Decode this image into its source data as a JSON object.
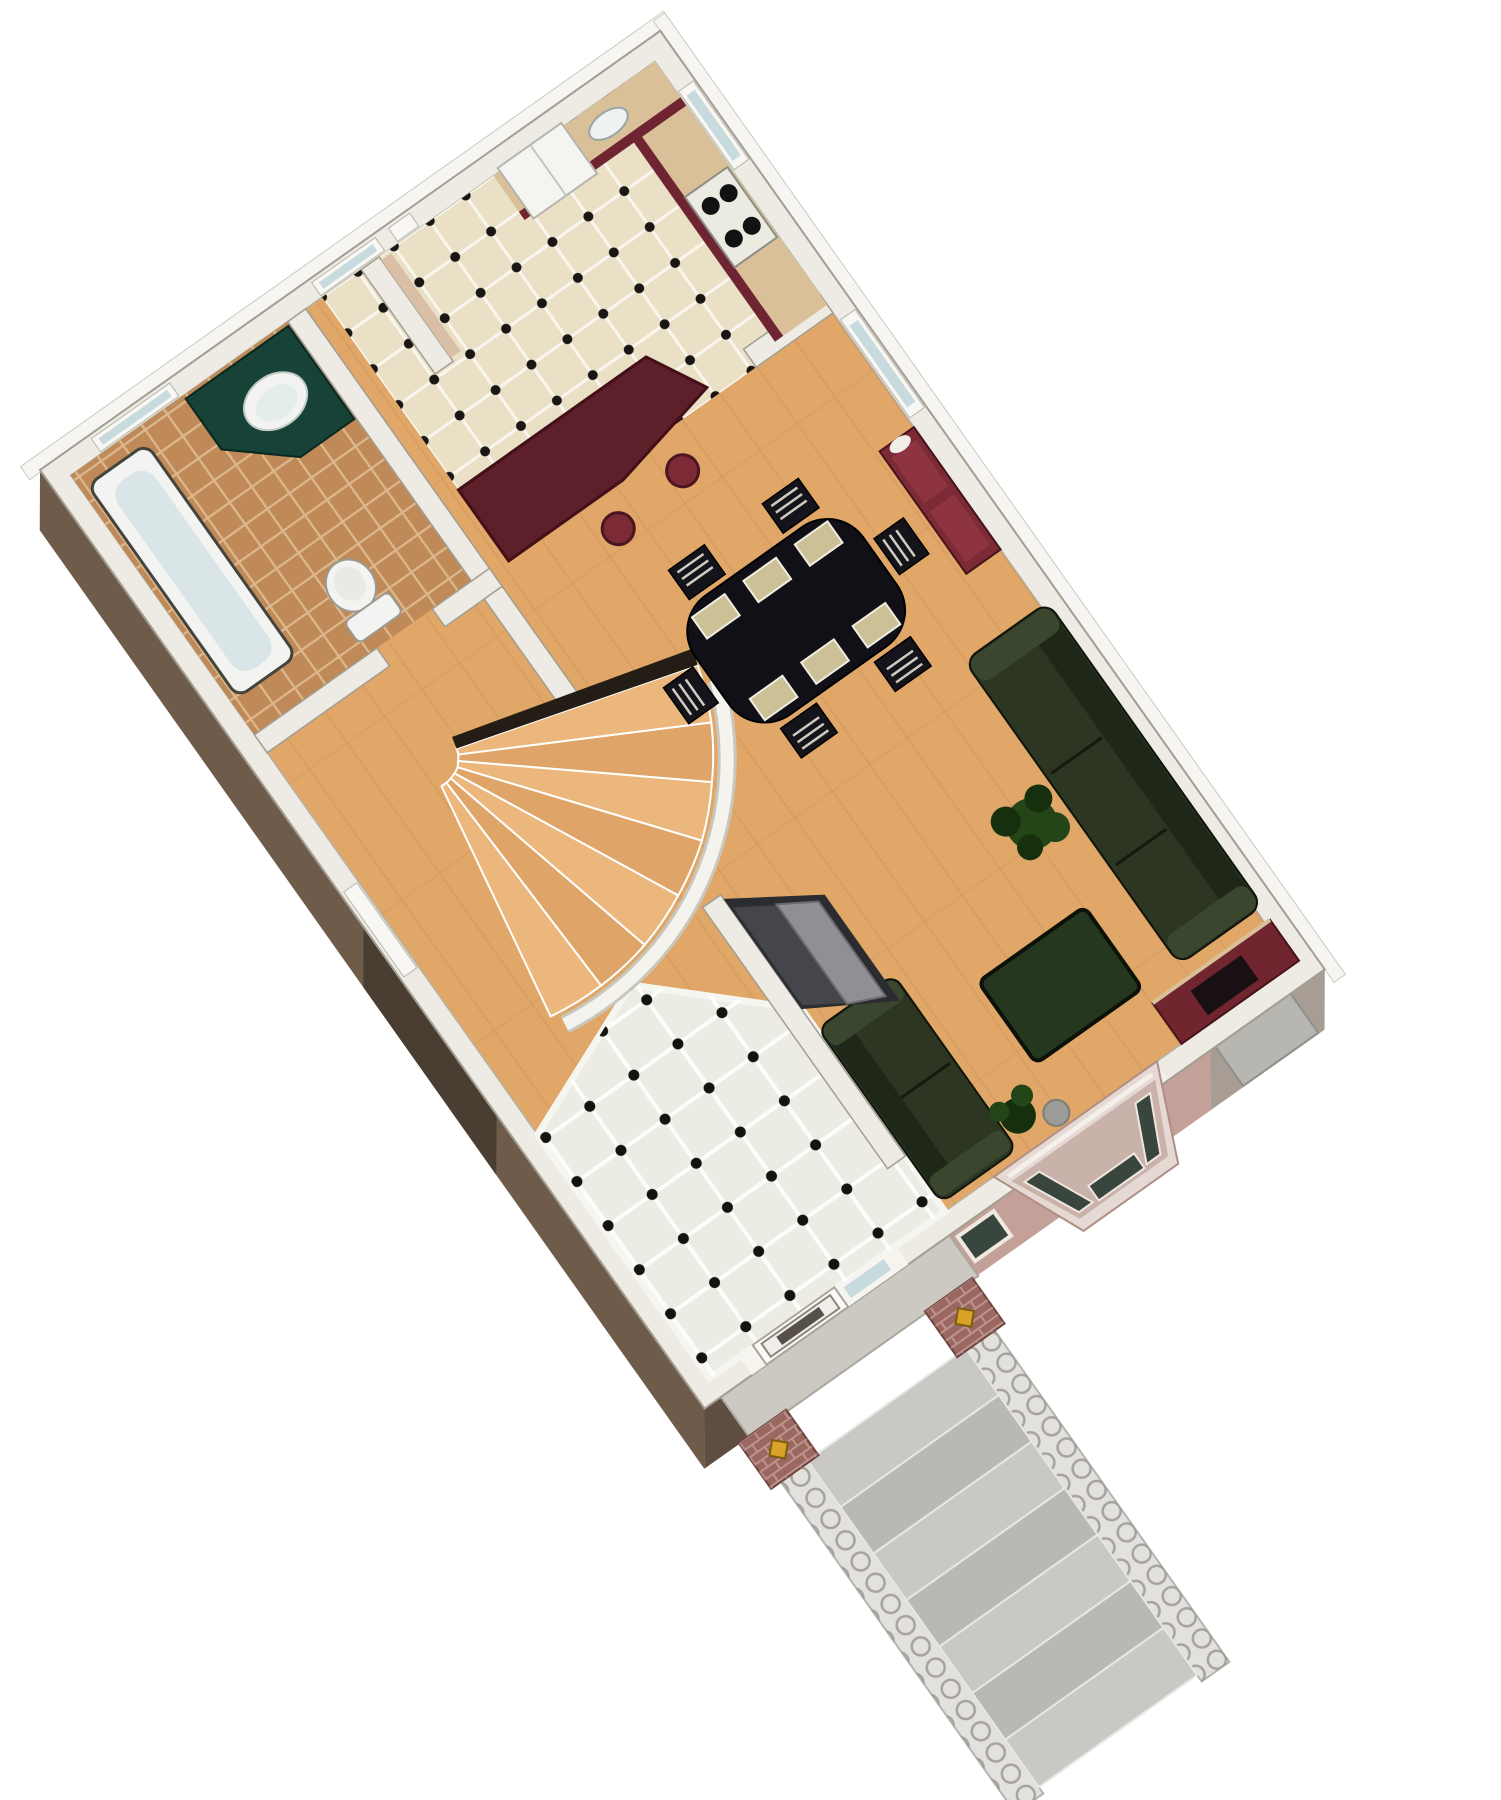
{
  "scene": {
    "type": "3d-floor-plan-render",
    "view": "isometric aerial cutaway, plan rotated about -35 degrees",
    "floor": "first floor",
    "background": "#ffffff"
  },
  "rooms": [
    {
      "name": "kitchen",
      "floor_finish": "cream tile with black diamond dots"
    },
    {
      "name": "dining-area",
      "floor_finish": "hardwood"
    },
    {
      "name": "living-room",
      "floor_finish": "hardwood"
    },
    {
      "name": "bathroom",
      "floor_finish": "terracotta grid tile"
    },
    {
      "name": "hall-stairs",
      "floor_finish": "hardwood winder staircase"
    },
    {
      "name": "foyer",
      "floor_finish": "white tile with black diamond dots"
    },
    {
      "name": "entry-porch",
      "floor_finish": "concrete with brick piers"
    }
  ],
  "furniture": [
    "refrigerator",
    "range-cooktop",
    "kitchen-counter",
    "peninsula-counter",
    "bar-stool",
    "bar-stool",
    "dining-table",
    "dining-chair x6",
    "placemats x6",
    "china-hutch",
    "sofa",
    "loveseat",
    "coffee-table",
    "potted-plant",
    "potted-plant",
    "decor-ball",
    "fireplace",
    "chimney",
    "bay-window",
    "bathtub",
    "vanity-with-sink",
    "toilet",
    "closet-doors",
    "front-door",
    "sidelight",
    "porch-sconce x2",
    "exterior-steps"
  ],
  "palette": {
    "wall_top": "#edebe3",
    "wall_edge": "#a29e92",
    "fascia": "#f6f5f1",
    "wood": "#e0a768",
    "kitchen_tile": "#e9e0c6",
    "foyer_tile": "#ecece4",
    "bath_tile": "#bf8a57",
    "maroon_cabinet": "#6f2531",
    "maroon_dark": "#5d1f2a",
    "counter_tan": "#d9c098",
    "hutch": "#7b2a36",
    "sofa_green": "#2c3622",
    "sofa_green_dark": "#1f2818",
    "sofa_green_light": "#3a472e",
    "table_black": "#101016",
    "chair_black": "#15141b",
    "mat_tan": "#ccc096",
    "vanity_green": "#174237",
    "tub_inner": "#d9e5e6",
    "porcelain": "#f3f4f1",
    "stairs_light": "#ecb77d",
    "stairs_dark": "#dfa468",
    "railing_white": "#f4f3ee",
    "closet_dark": "#45464c",
    "closet_gray": "#8f9096",
    "brick": "#a7736b",
    "pier_brick": "#9a6761",
    "gold": "#d9a32a",
    "steps_light": "#c9c8c4",
    "steps_dark": "#b9b8b4",
    "rail_gray": "#e2e1dd",
    "sw_face": "#6e5b49",
    "sw_face_dark": "#4a3d31",
    "se_brown": "#5e4d40",
    "se_pink": "#c4a198",
    "se_gray": "#a89d94",
    "glass": "#c7dade",
    "pane_dark": "#39463e",
    "chimney": "#b7b6b0",
    "plant": "#234517",
    "plant_dark": "#16300e",
    "coffee_table": "#25381f",
    "fireplace": "#70252f"
  }
}
